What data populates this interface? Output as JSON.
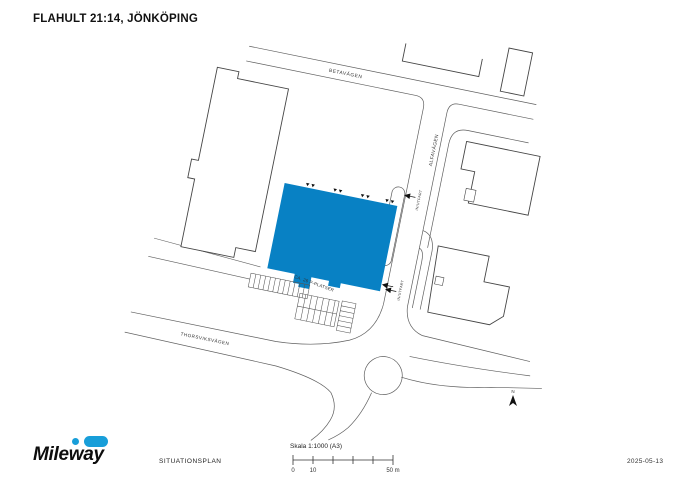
{
  "doc": {
    "title": "FLAHULT 21:14, JÖNKÖPING"
  },
  "map": {
    "labels": {
      "betavagen": "BETAVÄGEN",
      "alfavagen": "ALFAVÄGEN",
      "thorsviksvagen": "THORSVIKSVÄGEN",
      "in_utfart_upper": "IN/UTFART",
      "in_utfart_lower": "IN/UTFART",
      "parking": "CA. 26 P-PLATSER",
      "north": "N"
    },
    "colors": {
      "highlight_building": "#0881c4"
    }
  },
  "footer": {
    "logo_text": "Mileway",
    "logo_accent": "#189ed9",
    "doc_type_label": "SITUATIONSPLAN",
    "scale_label": "Skala 1:1000 (A3)",
    "scale_ticks": {
      "start": "0",
      "ten": "10",
      "end": "50 m"
    },
    "date": "2025-05-13"
  }
}
